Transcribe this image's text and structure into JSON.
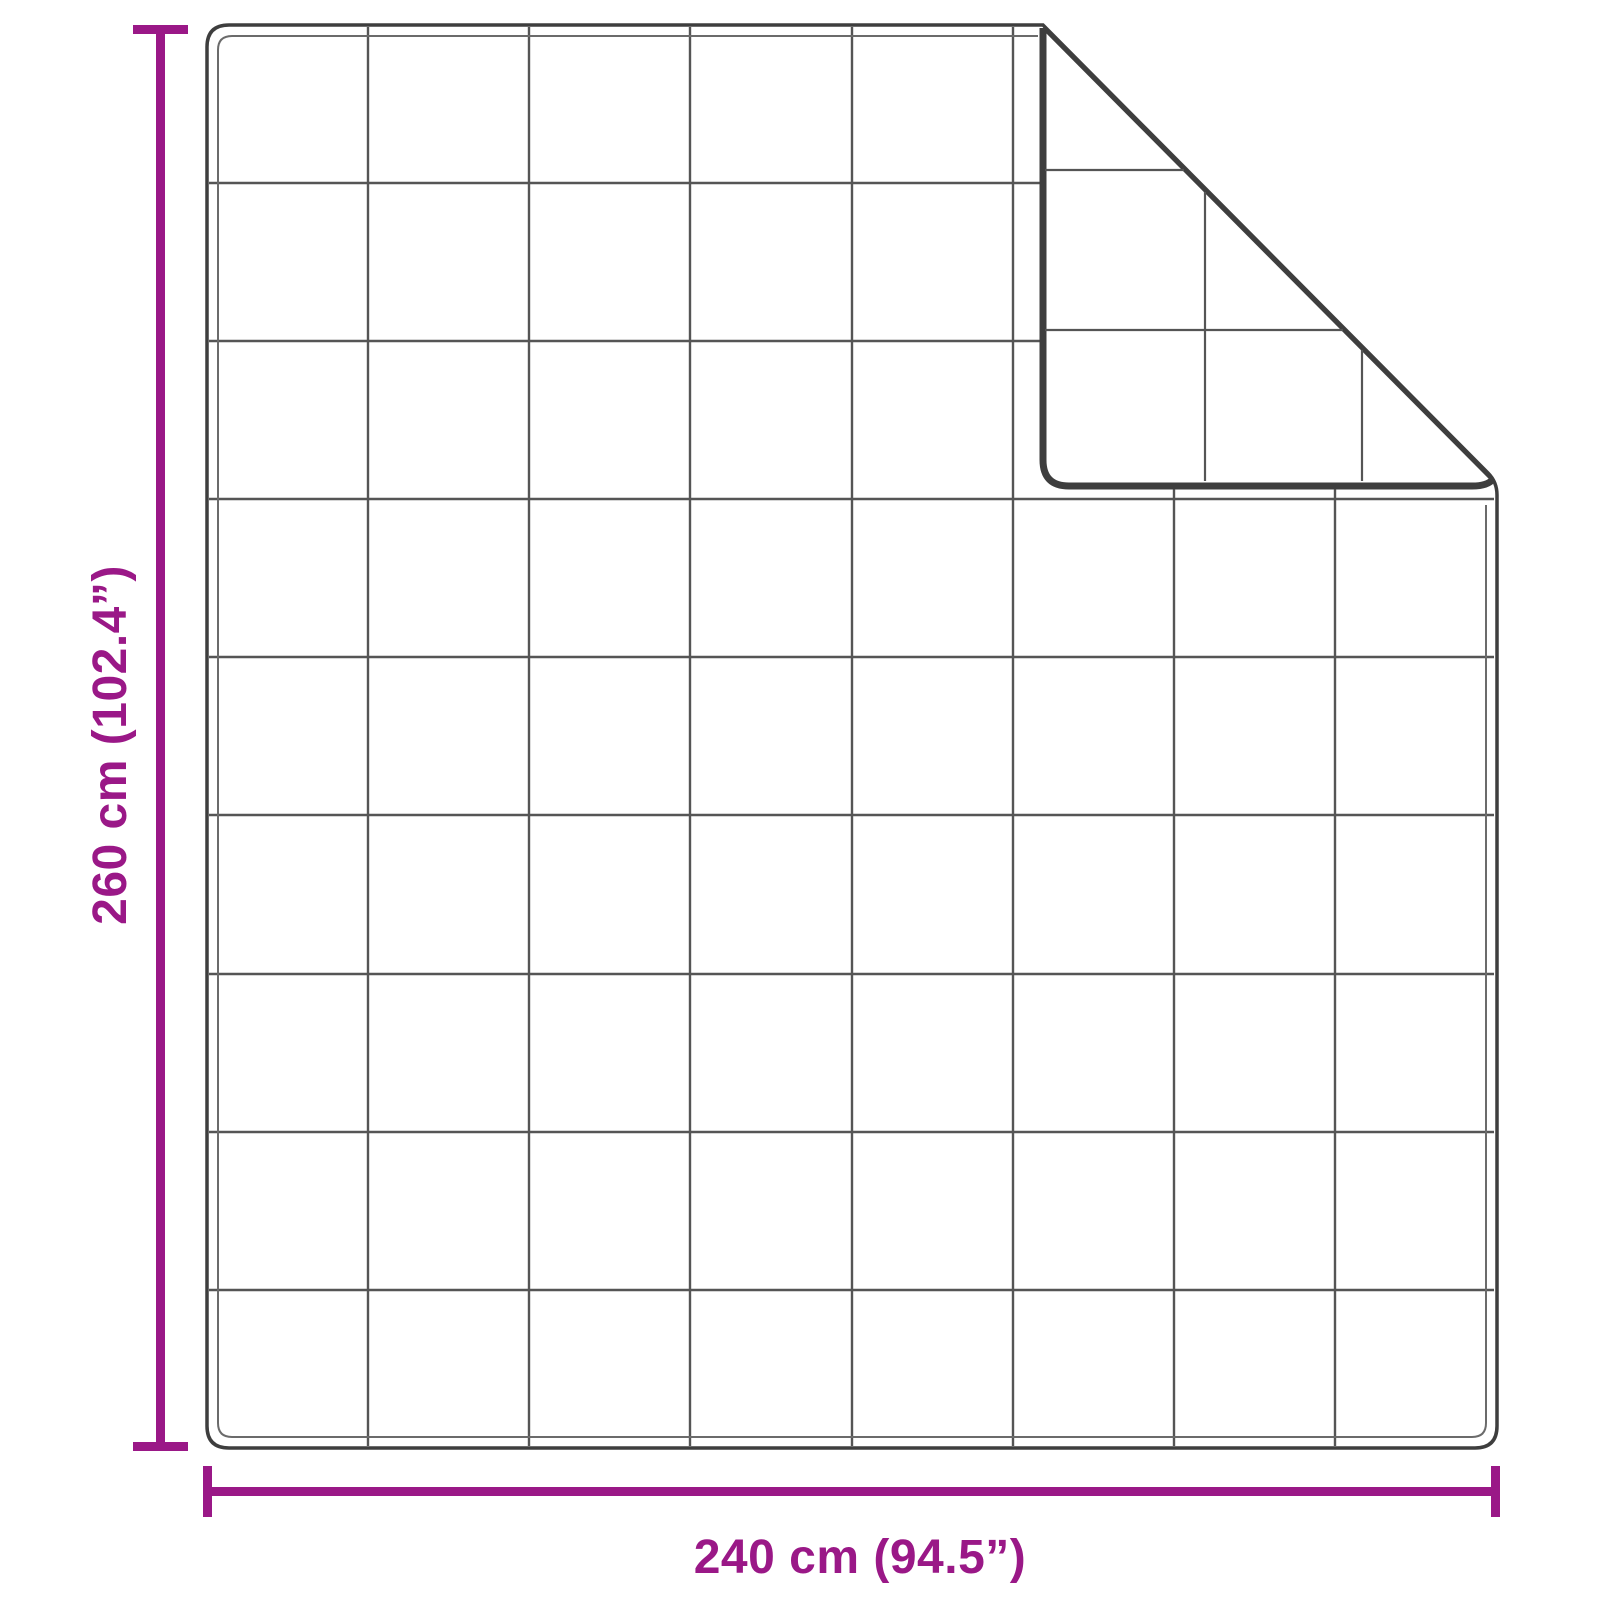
{
  "diagram": {
    "type": "blanket-dimension-diagram",
    "height_label": "260 cm (102.4”)",
    "width_label": "240 cm (94.5”)",
    "quilt_grid": {
      "columns": 8,
      "rows": 9
    },
    "colors": {
      "dimension": "#9A1887",
      "edge": "#3E3E3E",
      "grid": "#555555",
      "stitch": "#6B6B6B",
      "background": "#FFFFFF"
    }
  }
}
